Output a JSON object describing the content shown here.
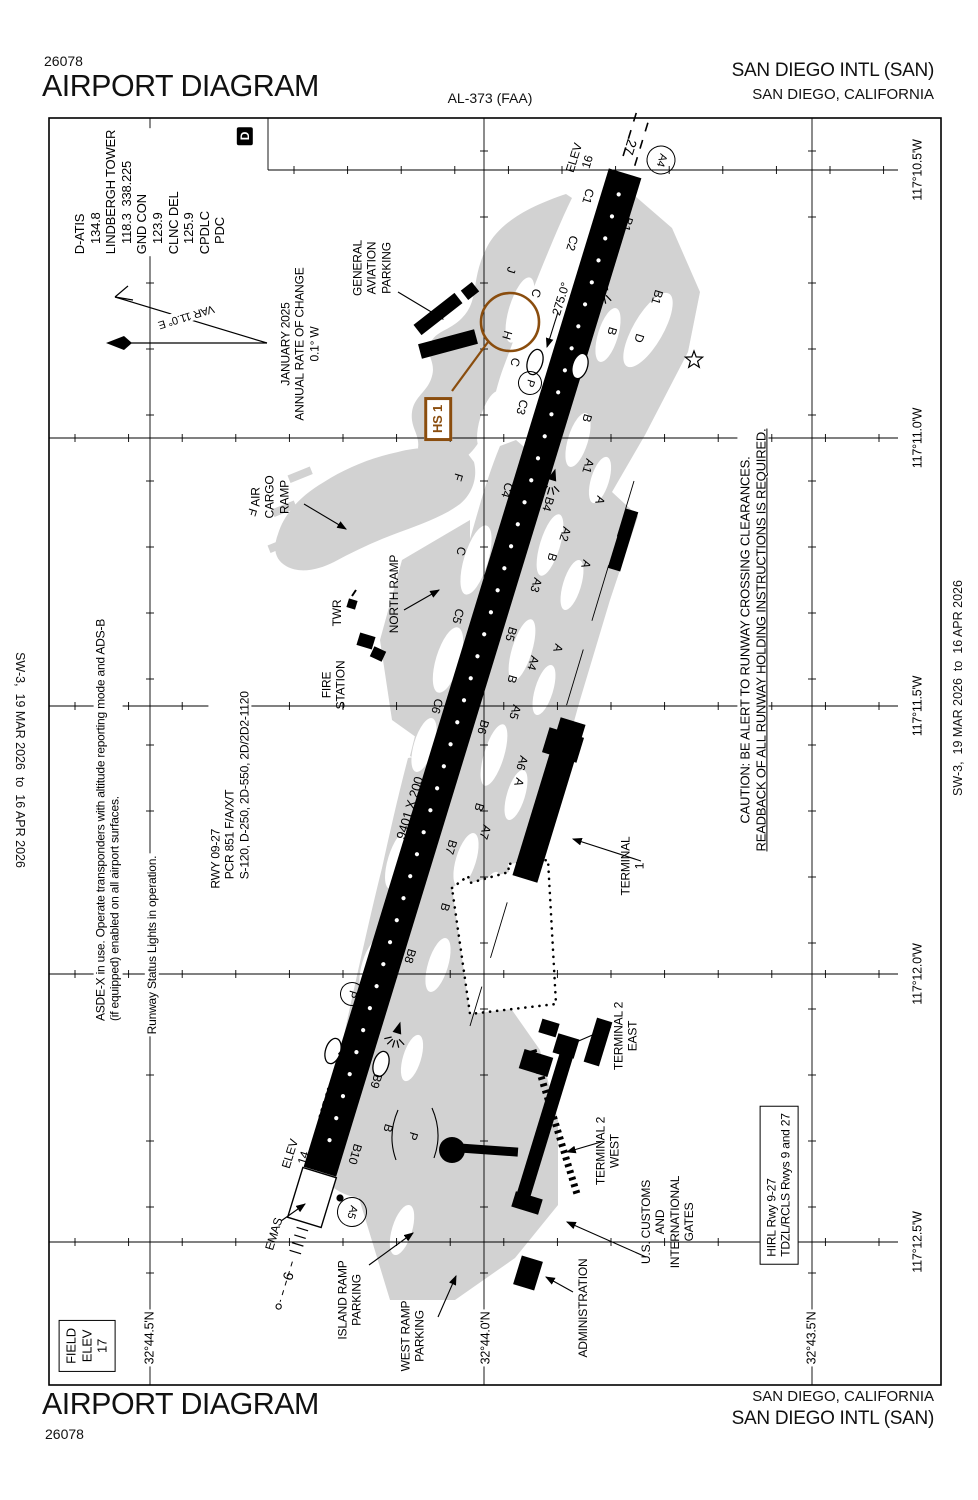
{
  "colors": {
    "apron_gray": "#d2d2d2",
    "ink": "#000000",
    "hotspot_brown": "#8a4d0e",
    "background": "#ffffff"
  },
  "header": {
    "chart_code": "26078",
    "title": "AIRPORT DIAGRAM",
    "procedure_id": "AL-373 (FAA)",
    "airport": "SAN DIEGO INTL (SAN)",
    "city": "SAN DIEGO, CALIFORNIA"
  },
  "footer": {
    "title": "AIRPORT DIAGRAM",
    "chart_code": "26078",
    "airport": "SAN DIEGO INTL (SAN)",
    "city": "SAN DIEGO, CALIFORNIA"
  },
  "margins": {
    "left_edition": "SW-3,  19 MAR 2026  to  16 APR 2026",
    "right_edition": "SW-3,  19 MAR 2026  to  16 APR 2026"
  },
  "runway": {
    "id": "9-27",
    "dimensions": "9401 X 200",
    "heading_27": "275.0°",
    "heading_9": "095.0°",
    "elev_27": "16",
    "elev_9": "14",
    "emas": "EMAS"
  },
  "labels": [
    {
      "n": "rwy27-number",
      "t": "27",
      "x": 630,
      "y": 147,
      "s": 14
    },
    {
      "n": "rwy27-elev",
      "t": [
        "ELEV",
        "16"
      ],
      "x": 581,
      "y": 160,
      "r": -73,
      "s": 12
    },
    {
      "n": "holdpad-a4",
      "t": "A4",
      "x": 661,
      "y": 160,
      "circ": 27,
      "s": 11
    },
    {
      "n": "taxiway-c1",
      "t": "C1",
      "x": 588,
      "y": 196
    },
    {
      "n": "taxiway-c2",
      "t": "C2",
      "x": 572,
      "y": 243
    },
    {
      "n": "taxiway-b1-north",
      "t": "B1",
      "x": 627,
      "y": 224
    },
    {
      "n": "taxiway-b1-south",
      "t": "B1",
      "x": 657,
      "y": 297
    },
    {
      "n": "taxiway-b-top",
      "t": "B",
      "x": 612,
      "y": 331
    },
    {
      "n": "taxiway-d",
      "t": "D",
      "x": 639,
      "y": 338
    },
    {
      "n": "rwy27-heading",
      "t": "275.0°",
      "x": 561,
      "y": 299,
      "r": -73,
      "s": 12
    },
    {
      "n": "taxiway-j",
      "t": "J",
      "x": 511,
      "y": 270
    },
    {
      "n": "taxiway-c-upper",
      "t": "C",
      "x": 536,
      "y": 293
    },
    {
      "n": "taxiway-h",
      "t": "H",
      "x": 507,
      "y": 335
    },
    {
      "n": "taxiway-c-mid",
      "t": "C",
      "x": 515,
      "y": 362
    },
    {
      "n": "parking-p-north",
      "t": "P",
      "x": 530,
      "y": 383,
      "circ": 22,
      "s": 11
    },
    {
      "n": "taxiway-c3",
      "t": "C3",
      "x": 522,
      "y": 407
    },
    {
      "n": "taxiway-b-2",
      "t": "B",
      "x": 587,
      "y": 418
    },
    {
      "n": "hotspot-hs1-label",
      "t": "HS 1",
      "x": 438,
      "y": 419,
      "r": -90,
      "s": 13,
      "box": "brown"
    },
    {
      "n": "taxiway-f-1",
      "t": "F",
      "x": 458,
      "y": 477
    },
    {
      "n": "taxiway-f-2",
      "t": "F",
      "x": 252,
      "y": 512
    },
    {
      "n": "taxiway-c4",
      "t": "C4",
      "x": 507,
      "y": 490
    },
    {
      "n": "taxiway-b4",
      "t": "B4",
      "x": 548,
      "y": 504
    },
    {
      "n": "taxiway-a1",
      "t": "A1",
      "x": 588,
      "y": 466
    },
    {
      "n": "taxiway-a-1",
      "t": "A",
      "x": 600,
      "y": 500
    },
    {
      "n": "taxiway-c-3",
      "t": "C",
      "x": 461,
      "y": 551
    },
    {
      "n": "taxiway-a2",
      "t": "A2",
      "x": 565,
      "y": 534
    },
    {
      "n": "taxiway-b-3",
      "t": "B",
      "x": 552,
      "y": 557
    },
    {
      "n": "taxiway-a3",
      "t": "A3",
      "x": 536,
      "y": 585
    },
    {
      "n": "taxiway-a-2",
      "t": "A",
      "x": 586,
      "y": 564
    },
    {
      "n": "taxiway-c5",
      "t": "C5",
      "x": 458,
      "y": 616
    },
    {
      "n": "taxiway-b5",
      "t": "B5",
      "x": 511,
      "y": 634
    },
    {
      "n": "taxiway-a4",
      "t": "A4",
      "x": 533,
      "y": 663
    },
    {
      "n": "taxiway-a-3",
      "t": "A",
      "x": 558,
      "y": 648
    },
    {
      "n": "taxiway-b-4",
      "t": "B",
      "x": 512,
      "y": 679
    },
    {
      "n": "taxiway-a5",
      "t": "A5",
      "x": 515,
      "y": 712
    },
    {
      "n": "taxiway-c6",
      "t": "C6",
      "x": 437,
      "y": 706
    },
    {
      "n": "taxiway-b6",
      "t": "B6",
      "x": 483,
      "y": 727
    },
    {
      "n": "taxiway-a6",
      "t": "A6",
      "x": 522,
      "y": 763
    },
    {
      "n": "taxiway-a-4",
      "t": "A",
      "x": 519,
      "y": 782
    },
    {
      "n": "taxiway-b-5",
      "t": "B",
      "x": 479,
      "y": 807
    },
    {
      "n": "taxiway-a7",
      "t": "A7",
      "x": 485,
      "y": 832
    },
    {
      "n": "taxiway-b7",
      "t": "B7",
      "x": 451,
      "y": 847
    },
    {
      "n": "rwy-dimensions",
      "t": "9401 X 200",
      "x": 410,
      "y": 808,
      "r": -73,
      "s": 13
    },
    {
      "n": "taxiway-b-6",
      "t": "B",
      "x": 445,
      "y": 907
    },
    {
      "n": "taxiway-b8",
      "t": "B8",
      "x": 410,
      "y": 956
    },
    {
      "n": "parking-p-south",
      "t": "P",
      "x": 352,
      "y": 994,
      "circ": 22,
      "s": 11
    },
    {
      "n": "taxiway-b9",
      "t": "B9",
      "x": 376,
      "y": 1081
    },
    {
      "n": "rwy9-heading",
      "t": "095.0°",
      "x": 327,
      "y": 1104,
      "r": -73,
      "s": 12
    },
    {
      "n": "taxiway-b-7",
      "t": "B",
      "x": 388,
      "y": 1128
    },
    {
      "n": "taxilane-p",
      "t": "P",
      "x": 413,
      "y": 1136
    },
    {
      "n": "taxiway-b10",
      "t": "B10",
      "x": 355,
      "y": 1154
    },
    {
      "n": "rwy9-elev",
      "t": [
        "ELEV",
        "14"
      ],
      "x": 297,
      "y": 1156,
      "r": -73,
      "s": 12
    },
    {
      "n": "holdpad-a5",
      "t": "A5",
      "x": 352,
      "y": 1212,
      "circ": 28,
      "s": 11
    },
    {
      "n": "emas-label",
      "t": "EMAS",
      "x": 274,
      "y": 1234,
      "r": -73,
      "s": 12
    },
    {
      "n": "rwy9-number",
      "t": "9",
      "x": 288,
      "y": 1276,
      "s": 14
    },
    {
      "n": "general-aviation-parking",
      "t": [
        "GENERAL",
        "AVIATION",
        "PARKING"
      ],
      "x": 372,
      "y": 268,
      "r": -90,
      "s": 12
    },
    {
      "n": "air-cargo-ramp",
      "t": [
        "AIR",
        "CARGO",
        "RAMP"
      ],
      "x": 270,
      "y": 497,
      "r": -90,
      "s": 12
    },
    {
      "n": "north-ramp",
      "t": "NORTH RAMP",
      "x": 394,
      "y": 594,
      "r": -90,
      "s": 12
    },
    {
      "n": "tower",
      "t": "TWR",
      "x": 337,
      "y": 613,
      "r": -90,
      "s": 12
    },
    {
      "n": "fire-station",
      "t": [
        "FIRE",
        "STATION"
      ],
      "x": 334,
      "y": 685,
      "r": -90,
      "s": 12
    },
    {
      "n": "terminal-1",
      "t": [
        "TERMINAL",
        "1"
      ],
      "x": 633,
      "y": 866,
      "r": -90,
      "s": 12
    },
    {
      "n": "terminal-2-east",
      "t": [
        "TERMINAL 2",
        "EAST"
      ],
      "x": 626,
      "y": 1036,
      "r": -90,
      "s": 12
    },
    {
      "n": "terminal-2-west",
      "t": [
        "TERMINAL 2",
        "WEST"
      ],
      "x": 608,
      "y": 1151,
      "r": -90,
      "s": 12
    },
    {
      "n": "us-customs",
      "t": [
        "U.S. CUSTOMS",
        "AND",
        "INTERNATIONAL",
        "GATES"
      ],
      "x": 668,
      "y": 1222,
      "r": -90,
      "s": 12
    },
    {
      "n": "administration",
      "t": "ADMINISTRATION",
      "x": 583,
      "y": 1308,
      "r": -90,
      "s": 12
    },
    {
      "n": "island-ramp-parking",
      "t": [
        "ISLAND RAMP",
        "PARKING"
      ],
      "x": 350,
      "y": 1300,
      "r": -90,
      "s": 12
    },
    {
      "n": "west-ramp-parking",
      "t": [
        "WEST RAMP",
        "PARKING"
      ],
      "x": 413,
      "y": 1336,
      "r": -90,
      "s": 12
    },
    {
      "n": "caution-note",
      "t": [
        "CAUTION: BE ALERT TO RUNWAY CROSSING CLEARANCES.",
        "READBACK OF ALL RUNWAY HOLDING INSTRUCTIONS IS REQUIRED."
      ],
      "x": 753,
      "y": 640,
      "r": -90,
      "s": 13,
      "u": 1,
      "bg": 1
    },
    {
      "n": "asdex-note",
      "t": [
        "ASDE-X in use. Operate transponders with altitude reporting mode and ADS-B",
        "(if equipped) enabled on all airport surfaces."
      ],
      "x": 108,
      "y": 820,
      "r": -90,
      "s": 12,
      "bg": 1,
      "left": 1
    },
    {
      "n": "rwsl-note",
      "t": "Runway Status Lights in operation.",
      "x": 152,
      "y": 945,
      "r": -90,
      "s": 12,
      "bg": 1
    },
    {
      "n": "runway-data-note",
      "t": [
        "RWY 09-27",
        "   PCR 851 F/A/X/T",
        "   S-120, D-250, 2D-550, 2D/2D2-1120"
      ],
      "x": 230,
      "y": 790,
      "r": -90,
      "s": 12,
      "bg": 1,
      "left": 1
    },
    {
      "n": "variation-date-note",
      "t": [
        "JANUARY 2025",
        "ANNUAL RATE OF CHANGE",
        "0.1° W"
      ],
      "x": 300,
      "y": 344,
      "r": -90,
      "s": 12,
      "bg": 1
    },
    {
      "n": "variation-value",
      "t": "VAR 11.0° E",
      "x": 186,
      "y": 316,
      "r": 163,
      "s": 11,
      "bg": 1
    },
    {
      "n": "communications",
      "t": [
        "D-ATIS",
        "   134.8",
        "LINDBERGH TOWER",
        "   118.3  338.225",
        "GND CON",
        "   123.9",
        "CLNC DEL",
        "   125.9",
        "CPDLC",
        "   PDC"
      ],
      "x": 150,
      "y": 192,
      "r": -90,
      "s": 13,
      "bg": 1,
      "left": 1
    },
    {
      "n": "cpdlc-d-symbol",
      "t": "D",
      "x": 245,
      "y": 136,
      "r": -90,
      "s": 12,
      "box": "filled"
    },
    {
      "n": "hirl-note",
      "t": [
        "HIRL Rwy 9-27",
        "TDZL/RCLS Rwys 9 and 27"
      ],
      "x": 779,
      "y": 1185,
      "r": -90,
      "s": 12,
      "box": "black",
      "left": 1
    },
    {
      "n": "field-elevation",
      "t": [
        "FIELD",
        "ELEV",
        "17"
      ],
      "x": 87,
      "y": 1346,
      "r": -90,
      "s": 13,
      "box": "black"
    },
    {
      "n": "longitude-117-10-5",
      "t": "117°10.5'W",
      "x": 918,
      "y": 170,
      "r": -90,
      "s": 12.5,
      "bg": 1
    },
    {
      "n": "longitude-117-11-0",
      "t": "117°11.0'W",
      "x": 918,
      "y": 438,
      "r": -90,
      "s": 12.5,
      "bg": 1
    },
    {
      "n": "longitude-117-11-5",
      "t": "117°11.5'W",
      "x": 918,
      "y": 706,
      "r": -90,
      "s": 12.5,
      "bg": 1
    },
    {
      "n": "longitude-117-12-0",
      "t": "117°12.0'W",
      "x": 918,
      "y": 974,
      "r": -90,
      "s": 12.5,
      "bg": 1
    },
    {
      "n": "longitude-117-12-5",
      "t": "117°12.5'W",
      "x": 918,
      "y": 1242,
      "r": -90,
      "s": 12.5,
      "bg": 1
    },
    {
      "n": "latitude-32-44-5",
      "t": "32°44.5'N",
      "x": 150,
      "y": 1338,
      "r": -90,
      "s": 12.5,
      "bg": 1
    },
    {
      "n": "latitude-32-44-0",
      "t": "32°44.0'N",
      "x": 486,
      "y": 1338,
      "r": -90,
      "s": 12.5,
      "bg": 1
    },
    {
      "n": "latitude-32-43-5",
      "t": "32°43.5'N",
      "x": 812,
      "y": 1338,
      "r": -90,
      "s": 12.5,
      "bg": 1
    }
  ]
}
